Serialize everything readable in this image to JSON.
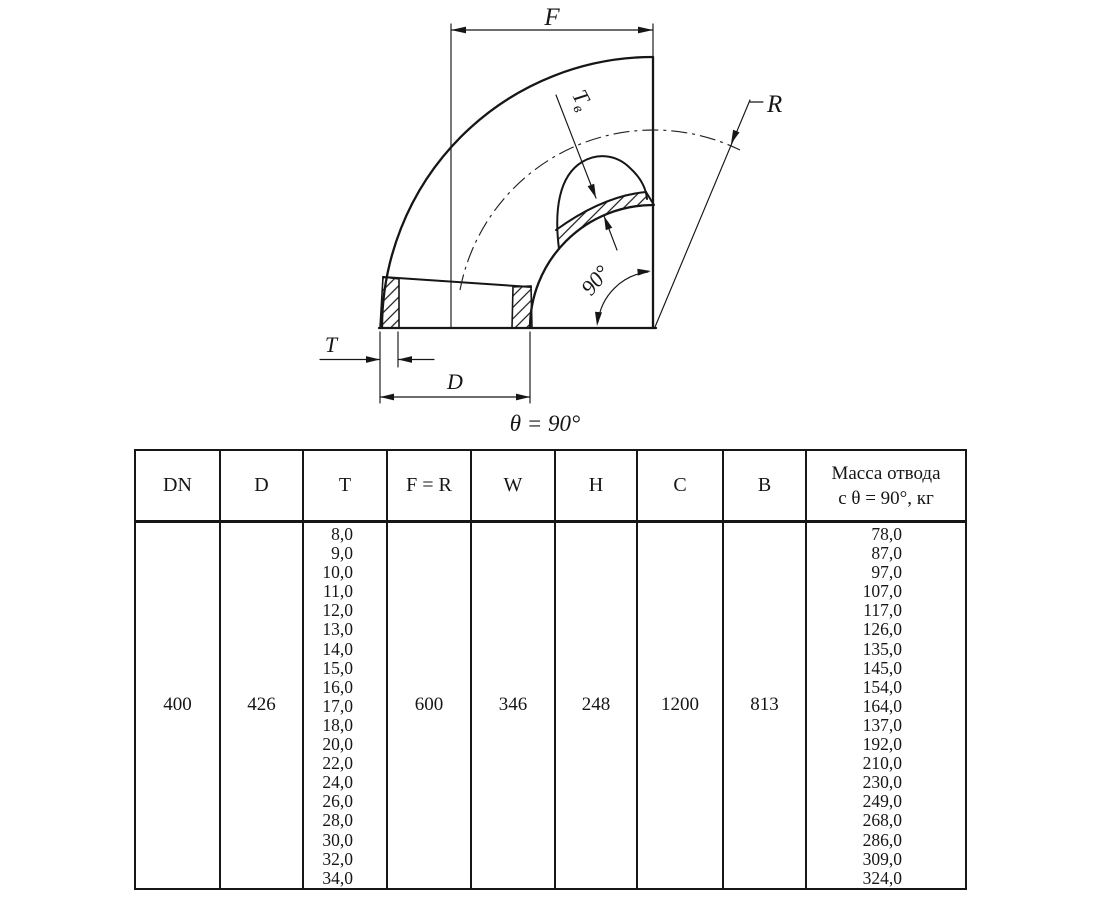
{
  "colors": {
    "ink": "#161616",
    "background": "#ffffff"
  },
  "drawing": {
    "f_label": "F",
    "r_label": "R",
    "t_label": "T",
    "d_label": "D",
    "tv_main": "T",
    "tv_sub": "в",
    "angle_label": "90°",
    "theta_caption": "θ = 90°"
  },
  "table": {
    "headers": [
      "DN",
      "D",
      "T",
      "F = R",
      "W",
      "H",
      "C",
      "B",
      "Масса отвода\nс θ =  90°, кг"
    ],
    "row": {
      "dn": "400",
      "d": "426",
      "t_values": [
        "8,0",
        "9,0",
        "10,0",
        "11,0",
        "12,0",
        "13,0",
        "14,0",
        "15,0",
        "16,0",
        "17,0",
        "18,0",
        "20,0",
        "22,0",
        "24,0",
        "26,0",
        "28,0",
        "30,0",
        "32,0",
        "34,0"
      ],
      "f_r": "600",
      "w": "346",
      "h": "248",
      "c": "1200",
      "b": "813",
      "mass_values": [
        "78,0",
        "87,0",
        "97,0",
        "107,0",
        "117,0",
        "126,0",
        "135,0",
        "145,0",
        "154,0",
        "164,0",
        "137,0",
        "192,0",
        "210,0",
        "230,0",
        "249,0",
        "268,0",
        "286,0",
        "309,0",
        "324,0"
      ]
    }
  }
}
